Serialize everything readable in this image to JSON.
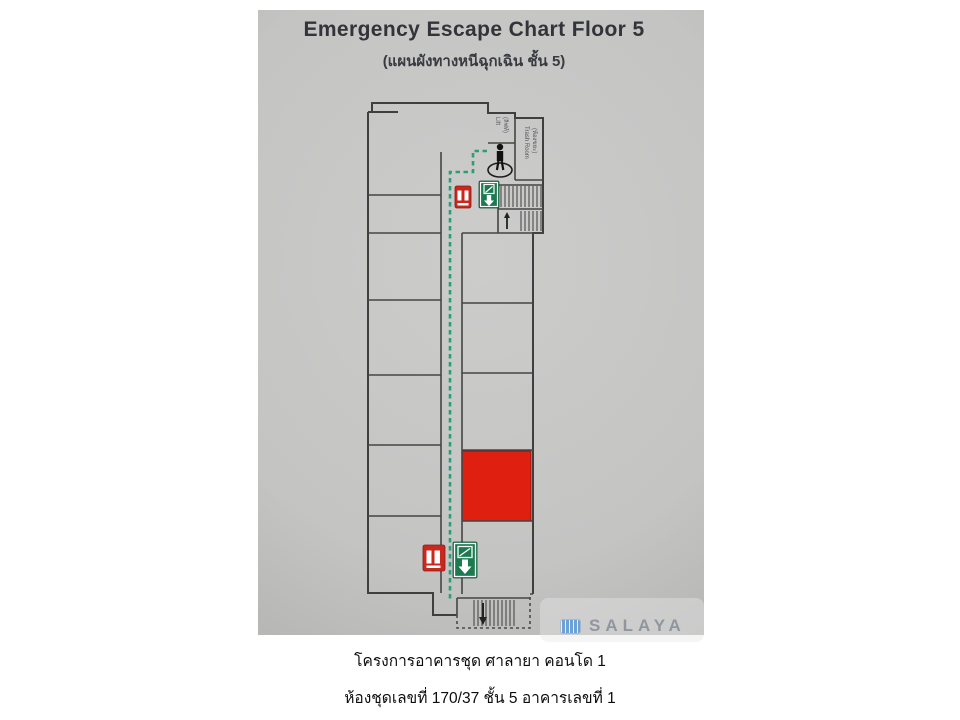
{
  "photo": {
    "title": "Emergency Escape Chart Floor 5",
    "subtitle": "(แผนผังทางหนีฉุกเฉิน ชั้น 5)",
    "logo": {
      "brand": "SALAYA"
    }
  },
  "floor_plan": {
    "floor": "5",
    "labels": {
      "lift_room_line1": "Lift",
      "lift_room_line2": "(ลิฟท์)",
      "trash_room_line1": "Trash Room",
      "trash_room_line2": "(ห้องขยะ)"
    },
    "icons": {
      "you_are_here": "person-silhouette-on-ellipse",
      "exit_sign": "green-square-running-man-with-down-arrow",
      "fire_equipment_sign": "red-square-fire-extinguisher",
      "stairs": "hatched-stair-flights-with-arrow"
    }
  },
  "colors": {
    "escape_route": "#2f9c78",
    "highlight_room": "#df1f10",
    "exit_sign_green": "#1c7a50",
    "fire_sign_red": "#c8281e",
    "logo_blue": "#6ba1d6"
  },
  "captions": {
    "line1": "โครงการอาคารชุด ศาลายา คอนโด 1",
    "line2": "ห้องชุดเลขที่ 170/37 ชั้น 5 อาคารเลขที่ 1"
  }
}
